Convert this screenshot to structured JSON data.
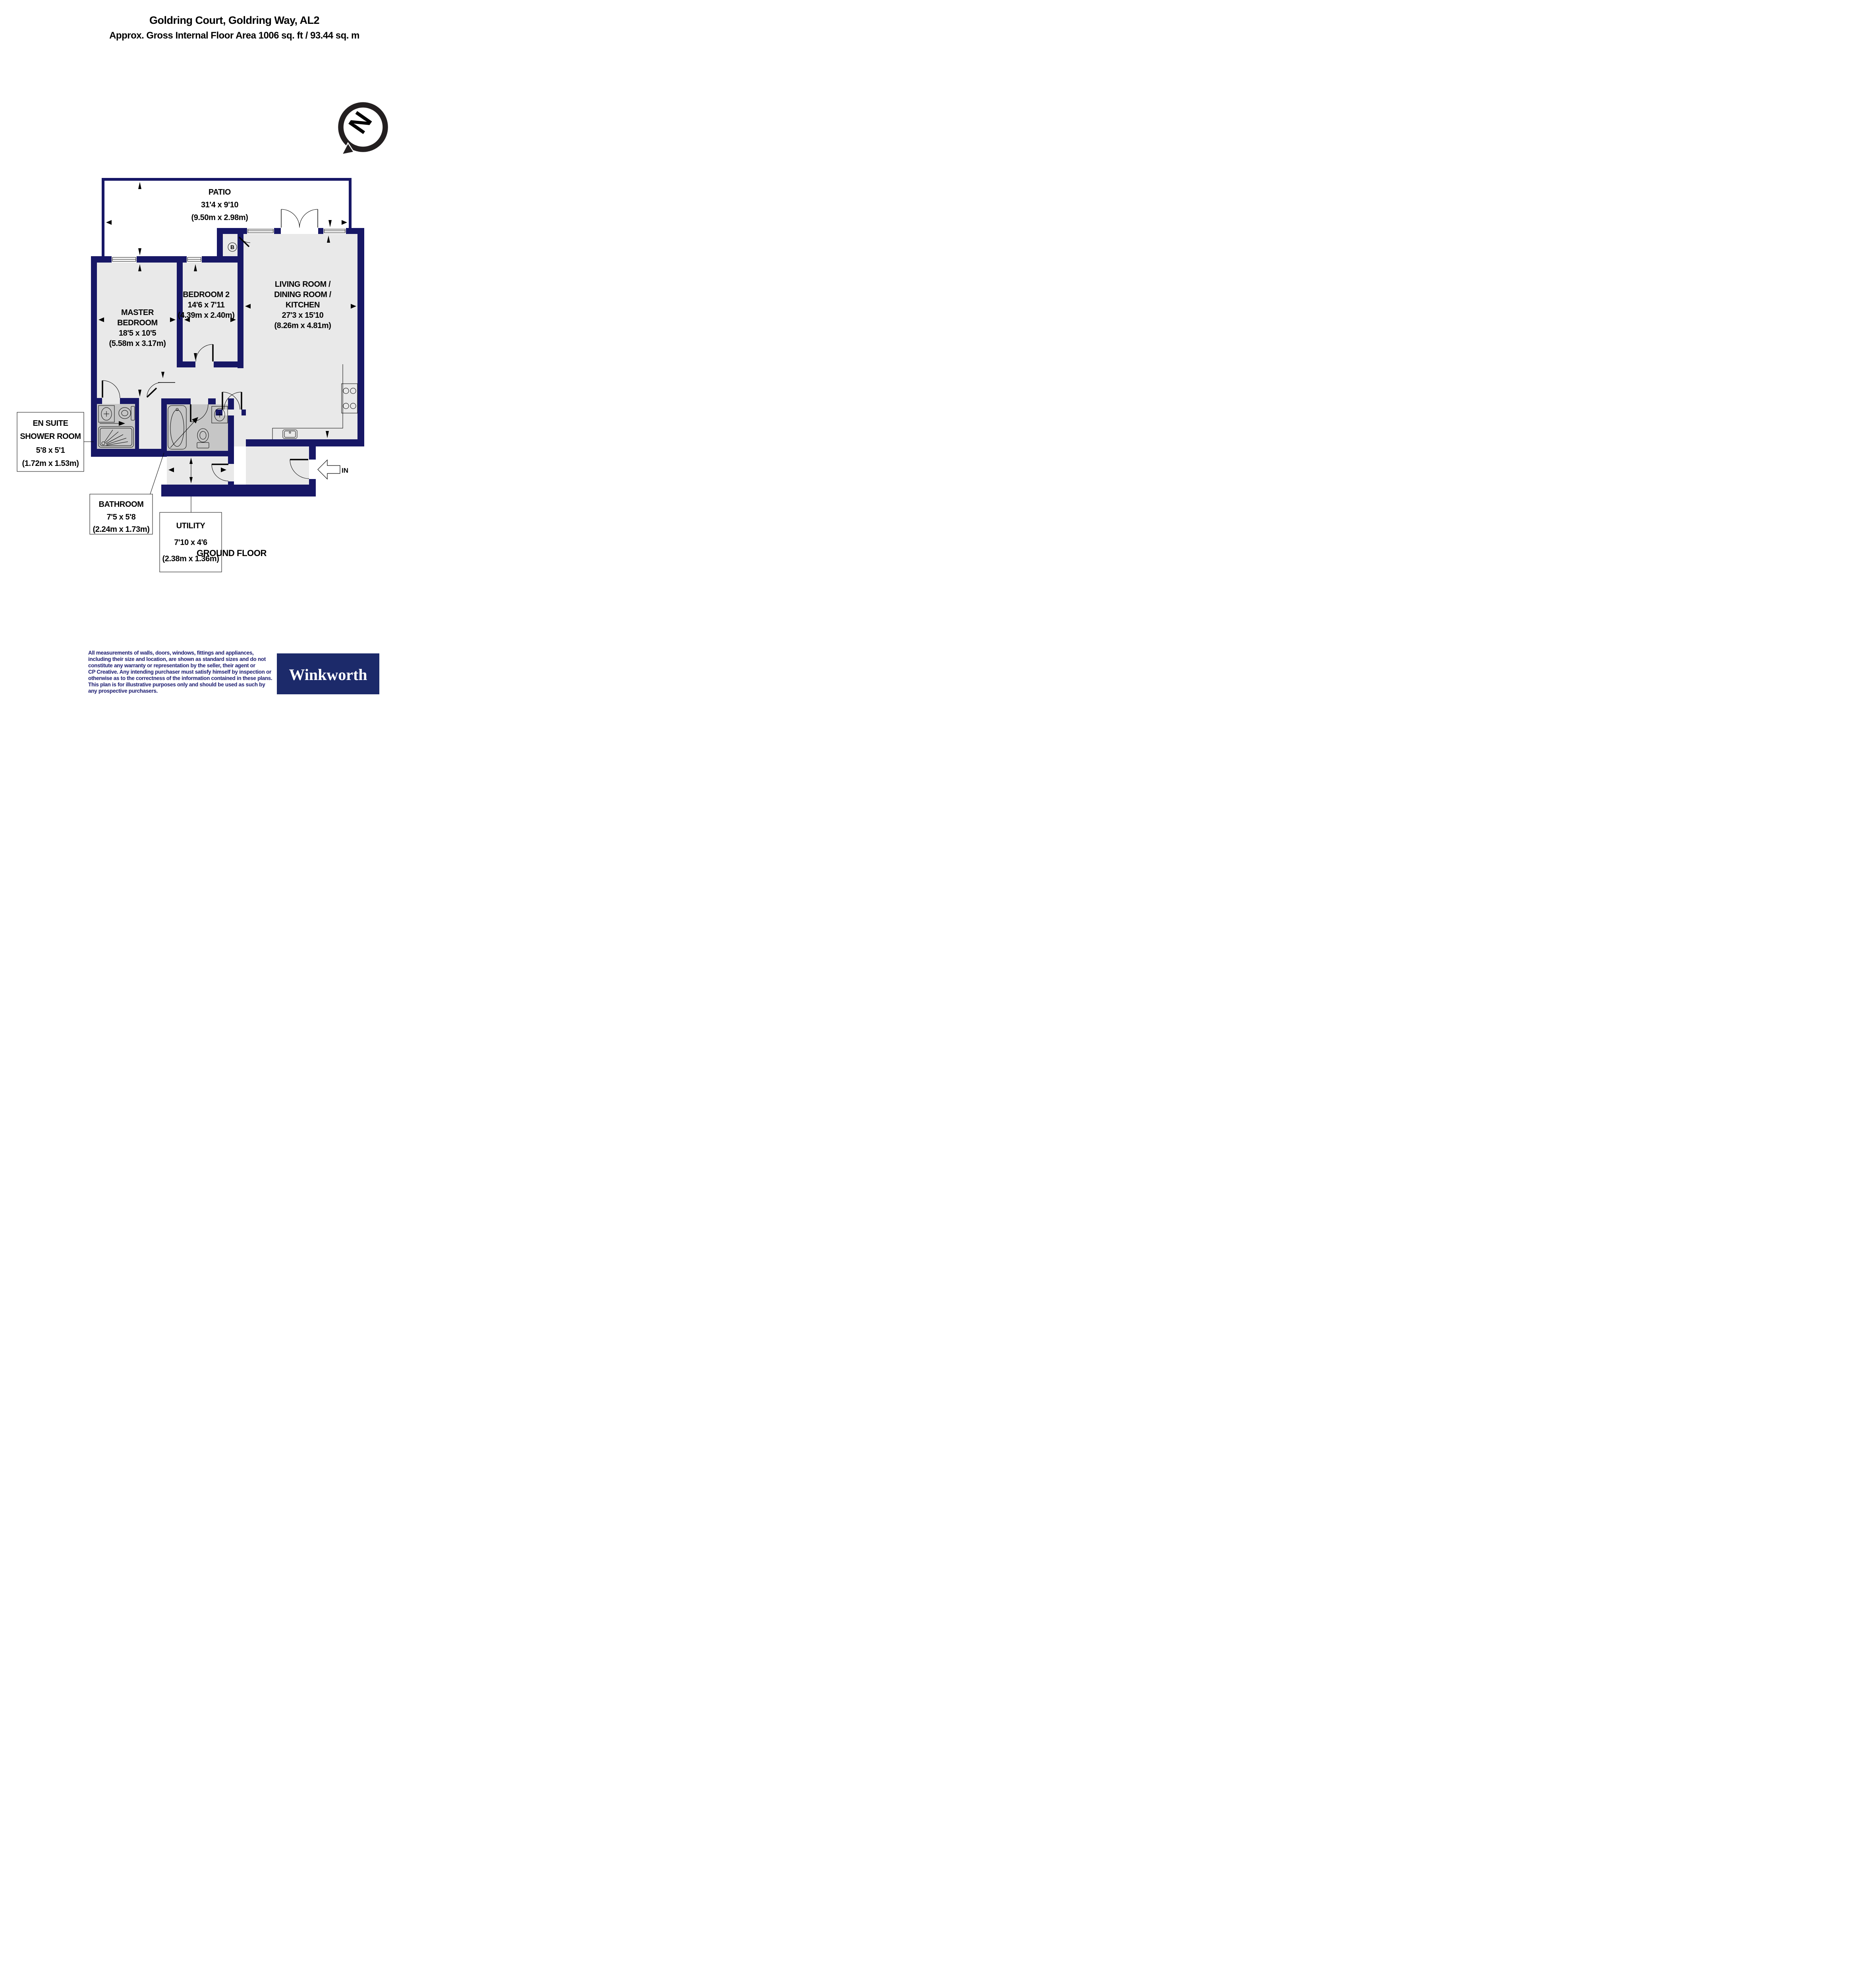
{
  "palette": {
    "wall": "#171766",
    "floor": "#e9e9e9",
    "wet_floor": "#c6c6c6",
    "disclaimer_text": "#1a1a70",
    "logo_background": "#1c2a6a",
    "compass_ring": "#231f20",
    "compass_letter": "#808080"
  },
  "header": {
    "title": "Goldring Court, Goldring Way, AL2",
    "subtitle": "Approx. Gross Internal Floor Area 1006 sq. ft / 93.44 sq. m"
  },
  "compass": {
    "letter": "N"
  },
  "rooms": {
    "patio": {
      "name": "PATIO",
      "imperial": "31'4 x 9'10",
      "metric": "(9.50m x 2.98m)"
    },
    "master": {
      "line1": "MASTER",
      "line2": "BEDROOM",
      "imperial": "18'5 x 10'5",
      "metric": "(5.58m x 3.17m)"
    },
    "bedroom2": {
      "name": "BEDROOM 2",
      "imperial": "14'6 x 7'11",
      "metric": "(4.39m x 2.40m)"
    },
    "living": {
      "line1": "LIVING ROOM /",
      "line2": "DINING ROOM /",
      "line3": "KITCHEN",
      "imperial": "27'3 x 15'10",
      "metric": "(8.26m x 4.81m)"
    },
    "ensuite": {
      "line1": "EN SUITE",
      "line2": "SHOWER ROOM",
      "imperial": "5'8 x 5'1",
      "metric": "(1.72m x 1.53m)"
    },
    "bathroom": {
      "name": "BATHROOM",
      "imperial": "7'5 x 5'8",
      "metric": "(2.24m x 1.73m)"
    },
    "utility": {
      "name": "UTILITY",
      "imperial": "7'10 x 4'6",
      "metric": "(2.38m x 1.36m)"
    }
  },
  "plan": {
    "boiler_label": "B",
    "entrance_label": "IN",
    "floor_label": "GROUND FLOOR"
  },
  "disclaimer": {
    "lines": [
      "All measurements of walls, doors, windows, fittings and appliances,",
      "including their size and location, are shown as standard sizes and do not",
      "constitute any warranty or representation by the seller, their agent or",
      "CP Creative. Any intending purchaser must satisfy himself by inspection or",
      "otherwise as to the correctness of the information contained in these plans.",
      "This plan is for illustrative purposes only and should be used as such by",
      "any prospective purchasers."
    ]
  },
  "logo": {
    "text": "Winkworth"
  }
}
